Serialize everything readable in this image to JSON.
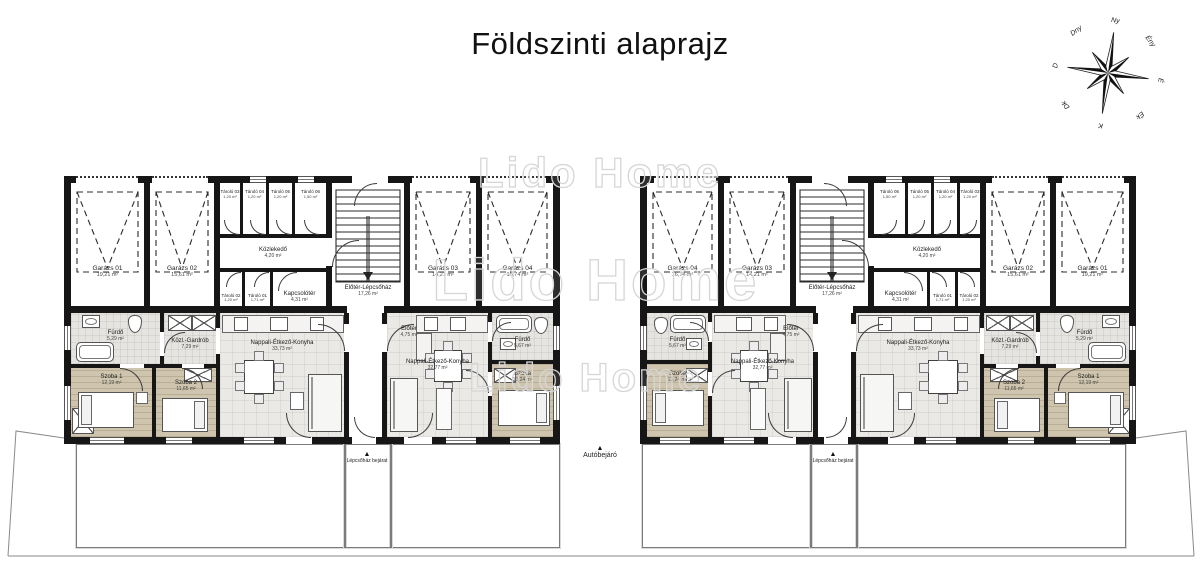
{
  "title": "Földszinti alaprajz",
  "watermark": {
    "text": "Lido Home",
    "instances": [
      {
        "x": 600,
        "y": 176,
        "size": 42
      },
      {
        "x": 596,
        "y": 285,
        "size": 58
      },
      {
        "x": 586,
        "y": 382,
        "size": 40
      }
    ]
  },
  "compass": {
    "labels": [
      "Ny",
      "Ény",
      "É",
      "Ék",
      "K",
      "Dk",
      "D",
      "Dny"
    ],
    "tilt": 8,
    "cx": 1108,
    "cy": 73
  },
  "site": {
    "drive_label": "Autóbejáró",
    "entrance_label": "Lépcsőház bejárat",
    "arrow": "▲",
    "yards": [
      {
        "x": 76,
        "y": 444,
        "w": 268,
        "h": 102
      },
      {
        "x": 390,
        "y": 444,
        "w": 168,
        "h": 102
      },
      {
        "x": 642,
        "y": 444,
        "w": 168,
        "h": 102
      },
      {
        "x": 856,
        "y": 444,
        "w": 268,
        "h": 102
      }
    ],
    "paths": [
      {
        "x": 344,
        "y": 444,
        "w": 46,
        "h": 102
      },
      {
        "x": 810,
        "y": 444,
        "w": 46,
        "h": 102
      }
    ],
    "drive": {
      "x": 558,
      "y": 444,
      "w": 84
    }
  },
  "buildings": [
    {
      "id": "left",
      "x": 64,
      "y": 176,
      "mirror": false
    },
    {
      "id": "right",
      "x": 640,
      "y": 176,
      "mirror": true
    }
  ],
  "plan": {
    "w": 496,
    "h": 268,
    "rooms": [
      {
        "name": "Garázs 01",
        "area": "19,21 m²",
        "x": 7,
        "y": 7,
        "w": 73,
        "h": 123,
        "floor": "none",
        "lsize": "g",
        "ly": 0.72
      },
      {
        "name": "Garázs 02",
        "area": "15,61 m²",
        "x": 86,
        "y": 7,
        "w": 64,
        "h": 123,
        "floor": "none",
        "lsize": "g",
        "ly": 0.72
      },
      {
        "name": "Tároló 03",
        "area": "1,20 m²",
        "x": 156,
        "y": 7,
        "w": 20,
        "h": 51,
        "floor": "none",
        "lsize": "s",
        "ly": 0.22
      },
      {
        "name": "Tároló 04",
        "area": "1,20 m²",
        "x": 179,
        "y": 7,
        "w": 23,
        "h": 51,
        "floor": "none",
        "lsize": "s",
        "ly": 0.22
      },
      {
        "name": "Tároló 05",
        "area": "1,20 m²",
        "x": 205,
        "y": 7,
        "w": 23,
        "h": 51,
        "floor": "none",
        "lsize": "s",
        "ly": 0.22
      },
      {
        "name": "Tároló 06",
        "area": "1,50 m²",
        "x": 231,
        "y": 7,
        "w": 31,
        "h": 51,
        "floor": "none",
        "lsize": "s",
        "ly": 0.22
      },
      {
        "name": "Közlekedő",
        "area": "4,20 m²",
        "x": 156,
        "y": 62,
        "w": 106,
        "h": 30,
        "floor": "none",
        "lsize": "s",
        "ly": 0.5
      },
      {
        "name": "Tároló 02",
        "area": "1,20 m²",
        "x": 156,
        "y": 98,
        "w": 22,
        "h": 32,
        "floor": "none",
        "lsize": "s",
        "ly": 0.75
      },
      {
        "name": "Tároló 01",
        "area": "1,71 m²",
        "x": 181,
        "y": 98,
        "w": 25,
        "h": 32,
        "floor": "none",
        "lsize": "s",
        "ly": 0.75
      },
      {
        "name": "Kapcsolótér",
        "area": "4,31 m²",
        "x": 209,
        "y": 98,
        "w": 53,
        "h": 32,
        "floor": "none",
        "lsize": "s",
        "ly": 0.72
      },
      {
        "name": "Előtér-Lépcsőház",
        "area": "17,26 m²",
        "x": 268,
        "y": 7,
        "w": 72,
        "h": 123,
        "floor": "none",
        "lsize": "s",
        "ly": 0.88
      },
      {
        "name": "Garázs 03",
        "area": "14,21 m²",
        "x": 346,
        "y": 7,
        "w": 66,
        "h": 123,
        "floor": "none",
        "lsize": "g",
        "ly": 0.72
      },
      {
        "name": "Garázs 04",
        "area": "16,74 m²",
        "x": 418,
        "y": 7,
        "w": 71,
        "h": 123,
        "floor": "none",
        "lsize": "g",
        "ly": 0.72
      },
      {
        "name": "Fürdő",
        "area": "5,29 m²",
        "x": 7,
        "y": 137,
        "w": 89,
        "h": 51,
        "floor": "bath",
        "lsize": "s",
        "ly": 0.45
      },
      {
        "name": "Közl.-Gardrób",
        "area": "7,29 m²",
        "x": 100,
        "y": 137,
        "w": 52,
        "h": 51,
        "floor": "bath",
        "lsize": "s",
        "ly": 0.62
      },
      {
        "name": "Szoba 1",
        "area": "12,19 m²",
        "x": 7,
        "y": 192,
        "w": 81,
        "h": 69,
        "floor": "wood",
        "lsize": "s",
        "ly": 0.18
      },
      {
        "name": "Szoba 2",
        "area": "11,65 m²",
        "x": 92,
        "y": 192,
        "w": 60,
        "h": 69,
        "floor": "wood",
        "lsize": "s",
        "ly": 0.26
      },
      {
        "name": "Nappali-Étkező-Konyha",
        "area": "33,73 m²",
        "x": 156,
        "y": 137,
        "w": 124,
        "h": 124,
        "floor": "tile",
        "lsize": "s",
        "ly": 0.27
      },
      {
        "name": "Előtér",
        "area": "4,75 m²",
        "x": 323,
        "y": 140,
        "w": 44,
        "h": 32,
        "floor": "none",
        "lsize": "s",
        "ly": 0.5
      },
      {
        "name": "Nappali-Étkező-Konyha",
        "area": "32,77 m²",
        "x": 323,
        "y": 137,
        "w": 101,
        "h": 124,
        "floor": "tile",
        "lsize": "s",
        "ly": 0.42
      },
      {
        "name": "Fürdő",
        "area": "5,67 m²",
        "x": 428,
        "y": 137,
        "w": 61,
        "h": 47,
        "floor": "bath",
        "lsize": "s",
        "ly": 0.64
      },
      {
        "name": "Szoba",
        "area": "13,24 m²",
        "x": 428,
        "y": 188,
        "w": 61,
        "h": 73,
        "floor": "wood",
        "lsize": "s",
        "ly": 0.18
      }
    ],
    "walls": [
      {
        "x": 0,
        "y": 0,
        "w": 496,
        "h": 7
      },
      {
        "x": 0,
        "y": 261,
        "w": 496,
        "h": 7
      },
      {
        "x": 0,
        "y": 0,
        "w": 7,
        "h": 268
      },
      {
        "x": 489,
        "y": 0,
        "w": 7,
        "h": 268
      },
      {
        "x": 0,
        "y": 130,
        "w": 496,
        "h": 7
      },
      {
        "x": 80,
        "y": 0,
        "w": 6,
        "h": 130
      },
      {
        "x": 150,
        "y": 0,
        "w": 6,
        "h": 130
      },
      {
        "x": 262,
        "y": 0,
        "w": 6,
        "h": 130
      },
      {
        "x": 340,
        "y": 0,
        "w": 6,
        "h": 130
      },
      {
        "x": 412,
        "y": 0,
        "w": 6,
        "h": 130
      },
      {
        "x": 150,
        "y": 58,
        "w": 118,
        "h": 4
      },
      {
        "x": 150,
        "y": 92,
        "w": 118,
        "h": 4
      },
      {
        "x": 176,
        "y": 0,
        "w": 3,
        "h": 60
      },
      {
        "x": 202,
        "y": 0,
        "w": 3,
        "h": 60
      },
      {
        "x": 228,
        "y": 0,
        "w": 3,
        "h": 60
      },
      {
        "x": 178,
        "y": 94,
        "w": 3,
        "h": 40
      },
      {
        "x": 206,
        "y": 94,
        "w": 3,
        "h": 40
      },
      {
        "x": 280,
        "y": 137,
        "w": 5,
        "h": 124
      },
      {
        "x": 318,
        "y": 137,
        "w": 5,
        "h": 124
      },
      {
        "x": 96,
        "y": 137,
        "w": 4,
        "h": 51
      },
      {
        "x": 152,
        "y": 137,
        "w": 4,
        "h": 124
      },
      {
        "x": 7,
        "y": 188,
        "w": 149,
        "h": 4
      },
      {
        "x": 88,
        "y": 192,
        "w": 4,
        "h": 69
      },
      {
        "x": 424,
        "y": 137,
        "w": 4,
        "h": 124
      },
      {
        "x": 428,
        "y": 184,
        "w": 61,
        "h": 4
      }
    ],
    "openings": [
      {
        "kind": "dot",
        "x": 12,
        "y": 0,
        "w": 62,
        "h": 7
      },
      {
        "kind": "dot",
        "x": 88,
        "y": 0,
        "w": 56,
        "h": 7
      },
      {
        "kind": "dot",
        "x": 348,
        "y": 0,
        "w": 58,
        "h": 7
      },
      {
        "kind": "dot",
        "x": 420,
        "y": 0,
        "w": 62,
        "h": 7
      },
      {
        "kind": "gap",
        "x": 288,
        "y": 0,
        "w": 36,
        "h": 7
      },
      {
        "kind": "win-h",
        "x": 186,
        "y": 0,
        "w": 16,
        "h": 7
      },
      {
        "kind": "win-h",
        "x": 234,
        "y": 0,
        "w": 16,
        "h": 7
      },
      {
        "kind": "gap",
        "x": 262,
        "y": 62,
        "w": 6,
        "h": 28
      },
      {
        "kind": "gap",
        "x": 283,
        "y": 130,
        "w": 37,
        "h": 7
      },
      {
        "kind": "gap",
        "x": 280,
        "y": 148,
        "w": 5,
        "h": 28
      },
      {
        "kind": "gap",
        "x": 318,
        "y": 148,
        "w": 5,
        "h": 28
      },
      {
        "kind": "gap",
        "x": 96,
        "y": 156,
        "w": 4,
        "h": 24
      },
      {
        "kind": "gap",
        "x": 152,
        "y": 152,
        "w": 4,
        "h": 26
      },
      {
        "kind": "gap",
        "x": 56,
        "y": 188,
        "w": 24,
        "h": 4
      },
      {
        "kind": "gap",
        "x": 118,
        "y": 188,
        "w": 22,
        "h": 4
      },
      {
        "kind": "gap",
        "x": 424,
        "y": 146,
        "w": 4,
        "h": 20
      },
      {
        "kind": "gap",
        "x": 424,
        "y": 196,
        "w": 4,
        "h": 24
      },
      {
        "kind": "win-h",
        "x": 26,
        "y": 261,
        "w": 34,
        "h": 7
      },
      {
        "kind": "win-h",
        "x": 102,
        "y": 261,
        "w": 26,
        "h": 7
      },
      {
        "kind": "win-h",
        "x": 180,
        "y": 261,
        "w": 30,
        "h": 7
      },
      {
        "kind": "gap",
        "x": 222,
        "y": 261,
        "w": 26,
        "h": 7
      },
      {
        "kind": "gap",
        "x": 288,
        "y": 261,
        "w": 24,
        "h": 7
      },
      {
        "kind": "gap",
        "x": 340,
        "y": 261,
        "w": 28,
        "h": 7
      },
      {
        "kind": "win-h",
        "x": 382,
        "y": 261,
        "w": 30,
        "h": 7
      },
      {
        "kind": "win-h",
        "x": 446,
        "y": 261,
        "w": 30,
        "h": 7
      },
      {
        "kind": "win-v",
        "x": 0,
        "y": 150,
        "w": 7,
        "h": 24
      },
      {
        "kind": "win-v",
        "x": 0,
        "y": 210,
        "w": 7,
        "h": 34
      },
      {
        "kind": "win-v",
        "x": 489,
        "y": 150,
        "w": 7,
        "h": 24
      },
      {
        "kind": "win-v",
        "x": 489,
        "y": 210,
        "w": 7,
        "h": 34
      }
    ],
    "doors": [
      {
        "x": 290,
        "y": 7,
        "r": 22,
        "q": "tl"
      },
      {
        "x": 268,
        "y": 64,
        "r": 26,
        "q": "tl"
      },
      {
        "x": 160,
        "y": 44,
        "r": 14,
        "q": "bl"
      },
      {
        "x": 186,
        "y": 44,
        "r": 14,
        "q": "bl"
      },
      {
        "x": 212,
        "y": 44,
        "r": 14,
        "q": "bl"
      },
      {
        "x": 240,
        "y": 44,
        "r": 14,
        "q": "bl"
      },
      {
        "x": 162,
        "y": 96,
        "r": 14,
        "q": "tl"
      },
      {
        "x": 190,
        "y": 96,
        "r": 14,
        "q": "tl"
      },
      {
        "x": 214,
        "y": 96,
        "r": 18,
        "q": "tl"
      },
      {
        "x": 254,
        "y": 148,
        "r": 26,
        "q": "tr"
      },
      {
        "x": 323,
        "y": 148,
        "r": 26,
        "q": "tl"
      },
      {
        "x": 100,
        "y": 156,
        "r": 20,
        "q": "tl"
      },
      {
        "x": 56,
        "y": 192,
        "r": 22,
        "q": "tr"
      },
      {
        "x": 118,
        "y": 192,
        "r": 20,
        "q": "tr"
      },
      {
        "x": 402,
        "y": 194,
        "r": 22,
        "q": "tr"
      },
      {
        "x": 428,
        "y": 146,
        "r": 18,
        "q": "tl"
      },
      {
        "x": 222,
        "y": 237,
        "r": 24,
        "q": "bl"
      },
      {
        "x": 344,
        "y": 237,
        "r": 24,
        "q": "br"
      },
      {
        "x": 290,
        "y": 241,
        "r": 20,
        "q": "bl"
      }
    ],
    "garage_doors": [
      {
        "x1": 13,
        "x2": 74
      },
      {
        "x1": 92,
        "x2": 144
      },
      {
        "x1": 352,
        "x2": 406
      },
      {
        "x1": 424,
        "x2": 483
      }
    ],
    "stairs": {
      "x": 272,
      "y": 14,
      "w": 64,
      "h": 92
    },
    "furniture": [
      {
        "t": "tub",
        "x": 12,
        "y": 166,
        "w": 36,
        "h": 18
      },
      {
        "t": "basin",
        "x": 18,
        "y": 139,
        "w": 16,
        "h": 11
      },
      {
        "t": "wc",
        "x": 64,
        "y": 139,
        "w": 12,
        "h": 16
      },
      {
        "t": "xbox",
        "x": 8,
        "y": 232,
        "w": 20,
        "h": 24
      },
      {
        "t": "xbox",
        "x": 104,
        "y": 139,
        "w": 22,
        "h": 14
      },
      {
        "t": "xbox",
        "x": 128,
        "y": 139,
        "w": 22,
        "h": 14
      },
      {
        "t": "counter",
        "x": 158,
        "y": 139,
        "w": 120,
        "h": 16
      },
      {
        "t": "appl",
        "x": 170,
        "y": 141,
        "w": 12,
        "h": 12
      },
      {
        "t": "appl",
        "x": 206,
        "y": 141,
        "w": 16,
        "h": 12
      },
      {
        "t": "appl",
        "x": 246,
        "y": 141,
        "w": 12,
        "h": 12
      },
      {
        "t": "table",
        "x": 180,
        "y": 184,
        "w": 28,
        "h": 32
      },
      {
        "t": "sofa",
        "x": 244,
        "y": 198,
        "w": 32,
        "h": 56
      },
      {
        "t": "nstand",
        "x": 226,
        "y": 216,
        "w": 12,
        "h": 16
      },
      {
        "t": "bed",
        "x": 14,
        "y": 216,
        "w": 54,
        "h": 34,
        "o": "left"
      },
      {
        "t": "nstand",
        "x": 72,
        "y": 216,
        "w": 10,
        "h": 10
      },
      {
        "t": "bed",
        "x": 98,
        "y": 222,
        "w": 44,
        "h": 32,
        "o": "right"
      },
      {
        "t": "xbox",
        "x": 120,
        "y": 192,
        "w": 26,
        "h": 12
      },
      {
        "t": "counter",
        "x": 352,
        "y": 139,
        "w": 70,
        "h": 16
      },
      {
        "t": "appl",
        "x": 360,
        "y": 141,
        "w": 12,
        "h": 12
      },
      {
        "t": "appl",
        "x": 386,
        "y": 141,
        "w": 14,
        "h": 12
      },
      {
        "t": "counter",
        "x": 352,
        "y": 157,
        "w": 14,
        "h": 26
      },
      {
        "t": "table",
        "x": 370,
        "y": 174,
        "w": 26,
        "h": 30
      },
      {
        "t": "sofa",
        "x": 326,
        "y": 202,
        "w": 26,
        "h": 52
      },
      {
        "t": "cab",
        "x": 372,
        "y": 212,
        "w": 14,
        "h": 40
      },
      {
        "t": "xbox",
        "x": 430,
        "y": 192,
        "w": 20,
        "h": 13
      },
      {
        "t": "tub",
        "x": 432,
        "y": 139,
        "w": 34,
        "h": 16
      },
      {
        "t": "wc",
        "x": 470,
        "y": 141,
        "w": 12,
        "h": 15
      },
      {
        "t": "basin",
        "x": 436,
        "y": 162,
        "w": 14,
        "h": 10
      },
      {
        "t": "bed",
        "x": 434,
        "y": 214,
        "w": 50,
        "h": 34,
        "o": "right"
      }
    ]
  }
}
